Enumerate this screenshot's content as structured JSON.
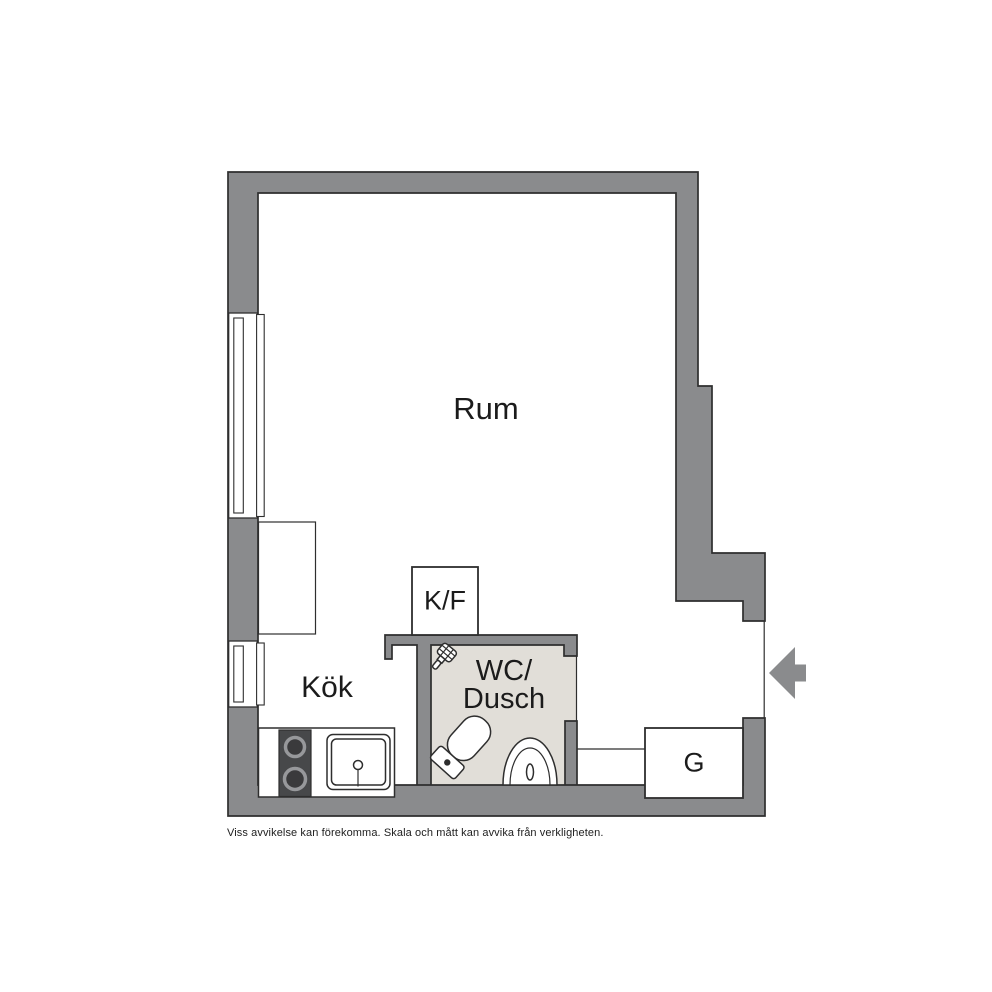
{
  "plan": {
    "rooms": {
      "main": {
        "label": "Rum"
      },
      "kitchen": {
        "label": "Kök"
      },
      "bathroom": {
        "label_line1": "WC/",
        "label_line2": "Dusch"
      },
      "fridge_freezer": {
        "label": "K/F"
      },
      "wardrobe": {
        "label": "G"
      }
    },
    "fixtures": [
      "stove-icon",
      "kitchen-sink-icon",
      "toilet-icon",
      "bathroom-sink-icon",
      "shower-icon",
      "entrance-arrow-icon",
      "window-upper",
      "window-lower",
      "cabinet-box"
    ],
    "disclaimer": "Viss avvikelse kan förekomma. Skala och mått kan avvika från verkligheten."
  },
  "colors": {
    "wall_fill": "#8a8b8d",
    "outline": "#2e2e2e",
    "bathroom_floor": "#e1ded8",
    "stove_fill": "#47484a",
    "background": "#ffffff",
    "text": "#1b1b1b"
  }
}
